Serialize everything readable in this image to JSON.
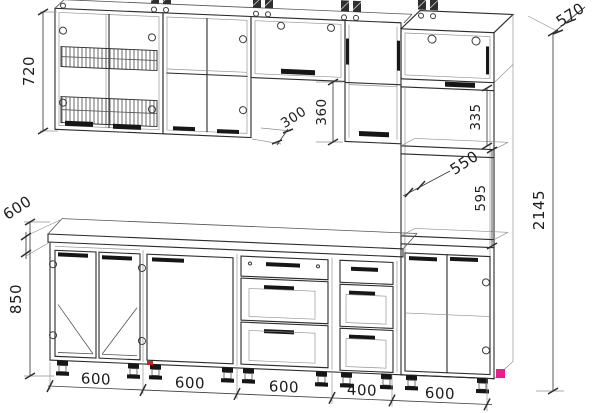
{
  "drawing": {
    "kind": "kitchen-cabinet-set-technical-drawing",
    "units": "mm"
  },
  "dimensions": {
    "wall_cabinet_height": "720",
    "wall_cabinet_depth": "300",
    "flip_cabinet_clearance": "360",
    "tall_top_cabinet_depth": "570",
    "open_shelf_height": "335",
    "worktop_to_wall_gap": "550",
    "oven_niche_height": "595",
    "total_height": "2145",
    "worktop_depth": "600",
    "base_cabinet_height": "850",
    "base_modules": [
      "600",
      "600",
      "600",
      "400",
      "600"
    ]
  },
  "colors": {
    "line": "#2b2b2b",
    "dimension": "#3c3c3c",
    "accent_marker": "#ec1c8d",
    "secondary_marker": "#cc2222",
    "background": "#ffffff"
  }
}
